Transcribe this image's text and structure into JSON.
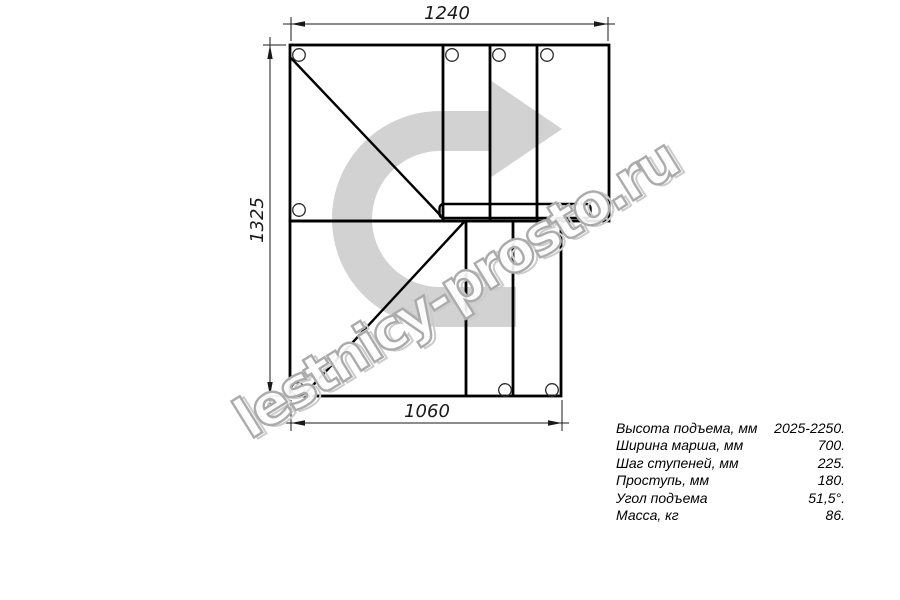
{
  "drawing": {
    "title": "staircase-plan-view",
    "dim_top": "1240",
    "dim_left": "1325",
    "dim_bottom": "1060"
  },
  "watermark": {
    "text": "lestnicy-prosto.ru",
    "arrow_color": "#d2d2d2",
    "outline_color": "#ababab"
  },
  "specs": {
    "rows": [
      {
        "label": "Высота подъема, мм",
        "value": "2025-2250."
      },
      {
        "label": "Ширина марша, мм",
        "value": "700."
      },
      {
        "label": "Шаг ступеней, мм",
        "value": "225."
      },
      {
        "label": "Проступь, мм",
        "value": "180."
      },
      {
        "label": "Угол подъема",
        "value": "51,5°."
      },
      {
        "label": "Масса, кг",
        "value": "86."
      }
    ]
  }
}
